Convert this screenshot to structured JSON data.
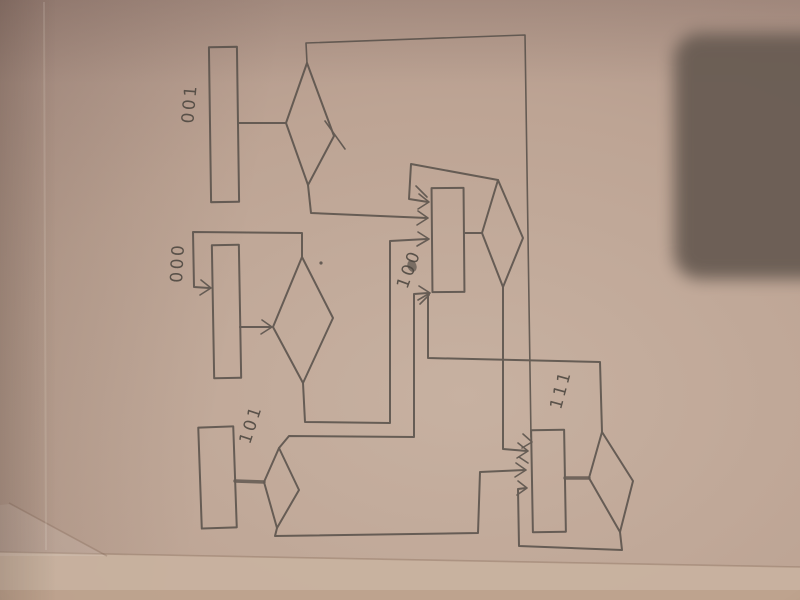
{
  "photo": {
    "description": "Pencil-sketched flowchart on paper, photographed rotated 90 degrees, with a rounded rectangular object shadow over the top-right corner and the paper edge visible along the bottom",
    "colors": {
      "paper": "#bda494",
      "pencil": "#564f48",
      "object_shadow": "#695c53",
      "under_surface": "#c9b2a0"
    }
  },
  "diagram": {
    "type": "hand-drawn state / flow diagram",
    "orientation": "drawn portrait, photographed landscape; labels read bottom-to-top",
    "nodes": [
      {
        "id": "state-001",
        "label": "001",
        "shape": "process box with decision diamond"
      },
      {
        "id": "state-000",
        "label": "000",
        "shape": "process box with decision diamond"
      },
      {
        "id": "state-100",
        "label": "100",
        "shape": "process box with decision diamond"
      },
      {
        "id": "state-101",
        "label": "101",
        "shape": "process box with decision diamond"
      },
      {
        "id": "state-111",
        "label": "111",
        "shape": "process box with decision diamond"
      }
    ],
    "edges": [
      {
        "from": "001 diamond (top exit)",
        "to": "111 box",
        "route": "across page top, down right side"
      },
      {
        "from": "001 diamond (bottom exit)",
        "to": "100 box"
      },
      {
        "from": "100 diamond (top exit)",
        "to": "100 box",
        "note": "self loop"
      },
      {
        "from": "000 diamond (top exit)",
        "to": "000 box",
        "note": "self loop"
      },
      {
        "from": "000 diamond (bottom exit)",
        "to": "100 box"
      },
      {
        "from": "101 diamond (top exit)",
        "to": "100 box"
      },
      {
        "from": "111 diamond (top exit)",
        "to": "100 box"
      },
      {
        "from": "100 diamond (bottom exit)",
        "to": "111 box"
      },
      {
        "from": "101 diamond (bottom exit)",
        "to": "111 box"
      },
      {
        "from": "111 diamond (bottom exit)",
        "to": "111 box",
        "note": "self loop"
      }
    ]
  }
}
